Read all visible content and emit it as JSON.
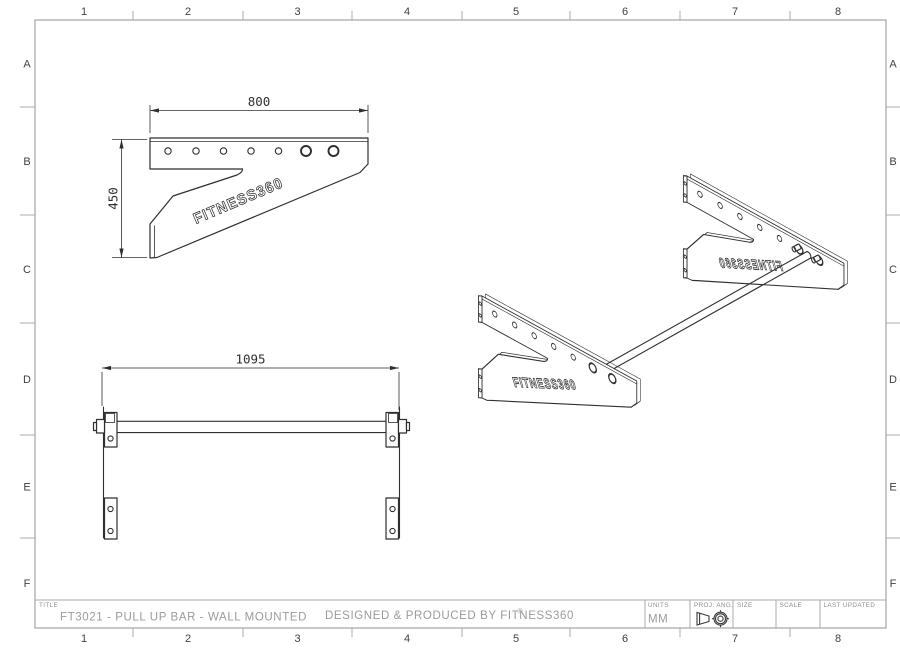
{
  "sheet": {
    "columns": [
      "1",
      "2",
      "3",
      "4",
      "5",
      "6",
      "7",
      "8"
    ],
    "rows": [
      "A",
      "B",
      "C",
      "D",
      "E",
      "F"
    ]
  },
  "title_block": {
    "title_label": "TITLE",
    "title": "FT3021 - PULL UP BAR - WALL MOUNTED",
    "produced_by": "DESIGNED & PRODUCED BY FITNESS360",
    "registered_mark": "®",
    "units_label": "UNITS",
    "units": "MM",
    "projection_label": "PROJ. ANG.",
    "size_label": "SIZE",
    "scale_label": "SCALE",
    "last_updated_label": "LAST UPDATED"
  },
  "views": {
    "side": {
      "width_dim": "800",
      "height_dim": "450",
      "brand": "FITNESS360"
    },
    "front": {
      "width_dim": "1095"
    },
    "iso": {
      "brand_near": "FITNESS360",
      "brand_far": "FITNESS360"
    }
  },
  "colors": {
    "line": "#2f2f2f",
    "border": "#ababab",
    "muted_text": "#9b9b9b",
    "grid_text": "#3f3f3f"
  }
}
